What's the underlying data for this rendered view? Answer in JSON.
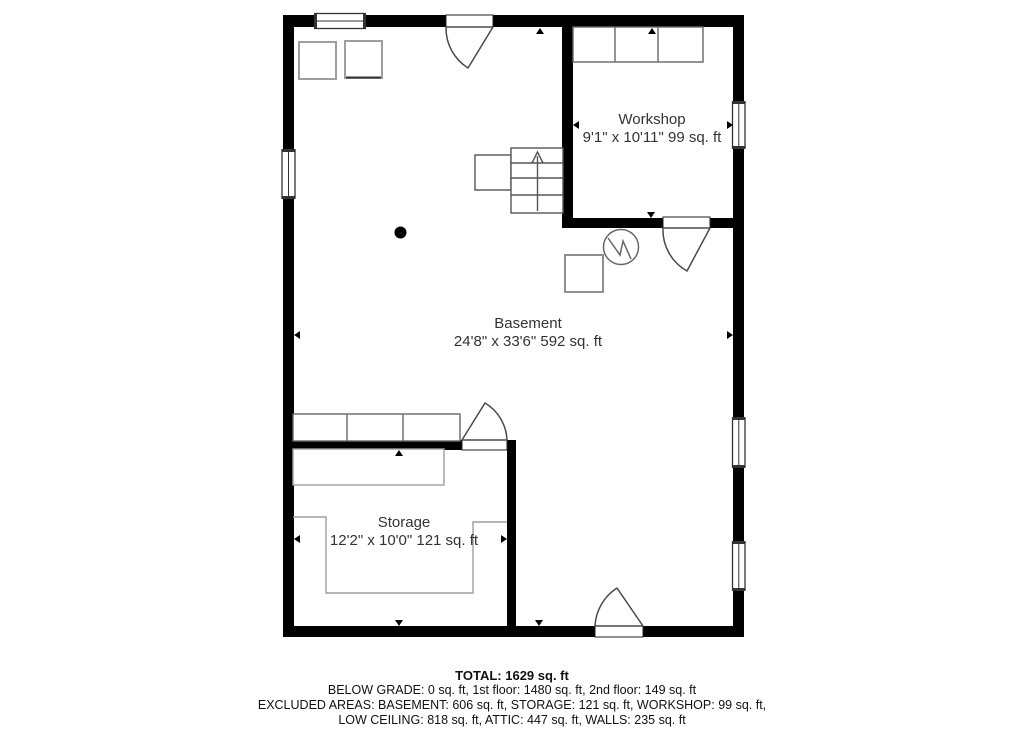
{
  "floor_plan": {
    "rooms": [
      {
        "name": "Workshop",
        "dimensions": "9'1\" x 10'11\" 99 sq. ft"
      },
      {
        "name": "Basement",
        "dimensions": "24'8\" x 33'6\" 592 sq. ft"
      },
      {
        "name": "Storage",
        "dimensions": "12'2\" x 10'0\" 121 sq. ft"
      }
    ],
    "summary": {
      "total": "TOTAL: 1629 sq. ft",
      "below_grade": "BELOW GRADE: 0 sq. ft, 1st floor: 1480 sq. ft, 2nd floor: 149 sq. ft",
      "excluded_areas": "EXCLUDED AREAS: BASEMENT: 606 sq. ft, STORAGE: 121 sq. ft, WORKSHOP: 99 sq. ft,",
      "low_ceiling": "LOW CEILING: 818 sq. ft, ATTIC: 447 sq. ft, WALLS: 235 sq. ft"
    },
    "colors": {
      "wall": "#000000",
      "furniture_outline": "#9e9e9e",
      "fixture_outline": "#555555",
      "label_text": "#333333",
      "summary_text": "#111111",
      "background": "#ffffff"
    },
    "symbols": [
      "window",
      "door-swing",
      "stairs-up-arrow",
      "support-column",
      "utility-circle",
      "appliance-square",
      "workbench",
      "shelf",
      "dimension-marker"
    ]
  }
}
